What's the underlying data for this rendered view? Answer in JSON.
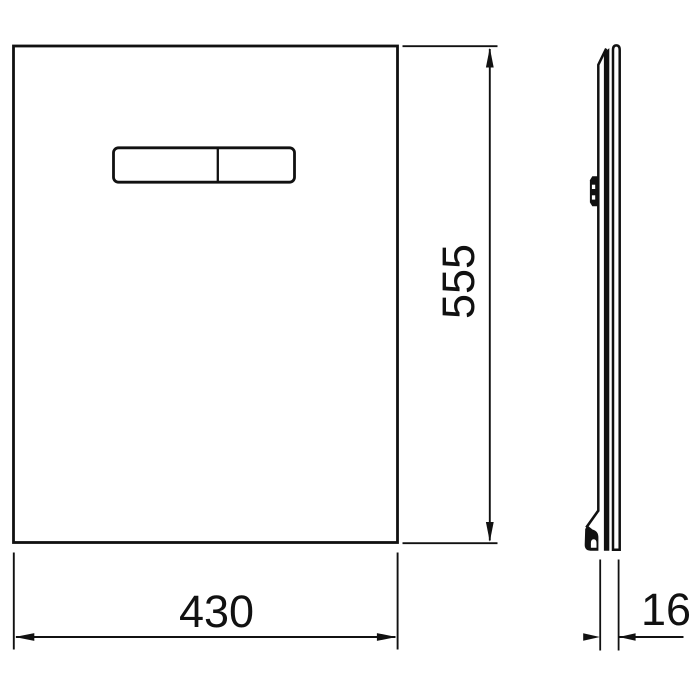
{
  "canvas": {
    "background_color": "#ffffff",
    "line_color": "#111111"
  },
  "drawing": {
    "dimensions": {
      "height": "555",
      "width": "430",
      "depth": "16"
    }
  }
}
